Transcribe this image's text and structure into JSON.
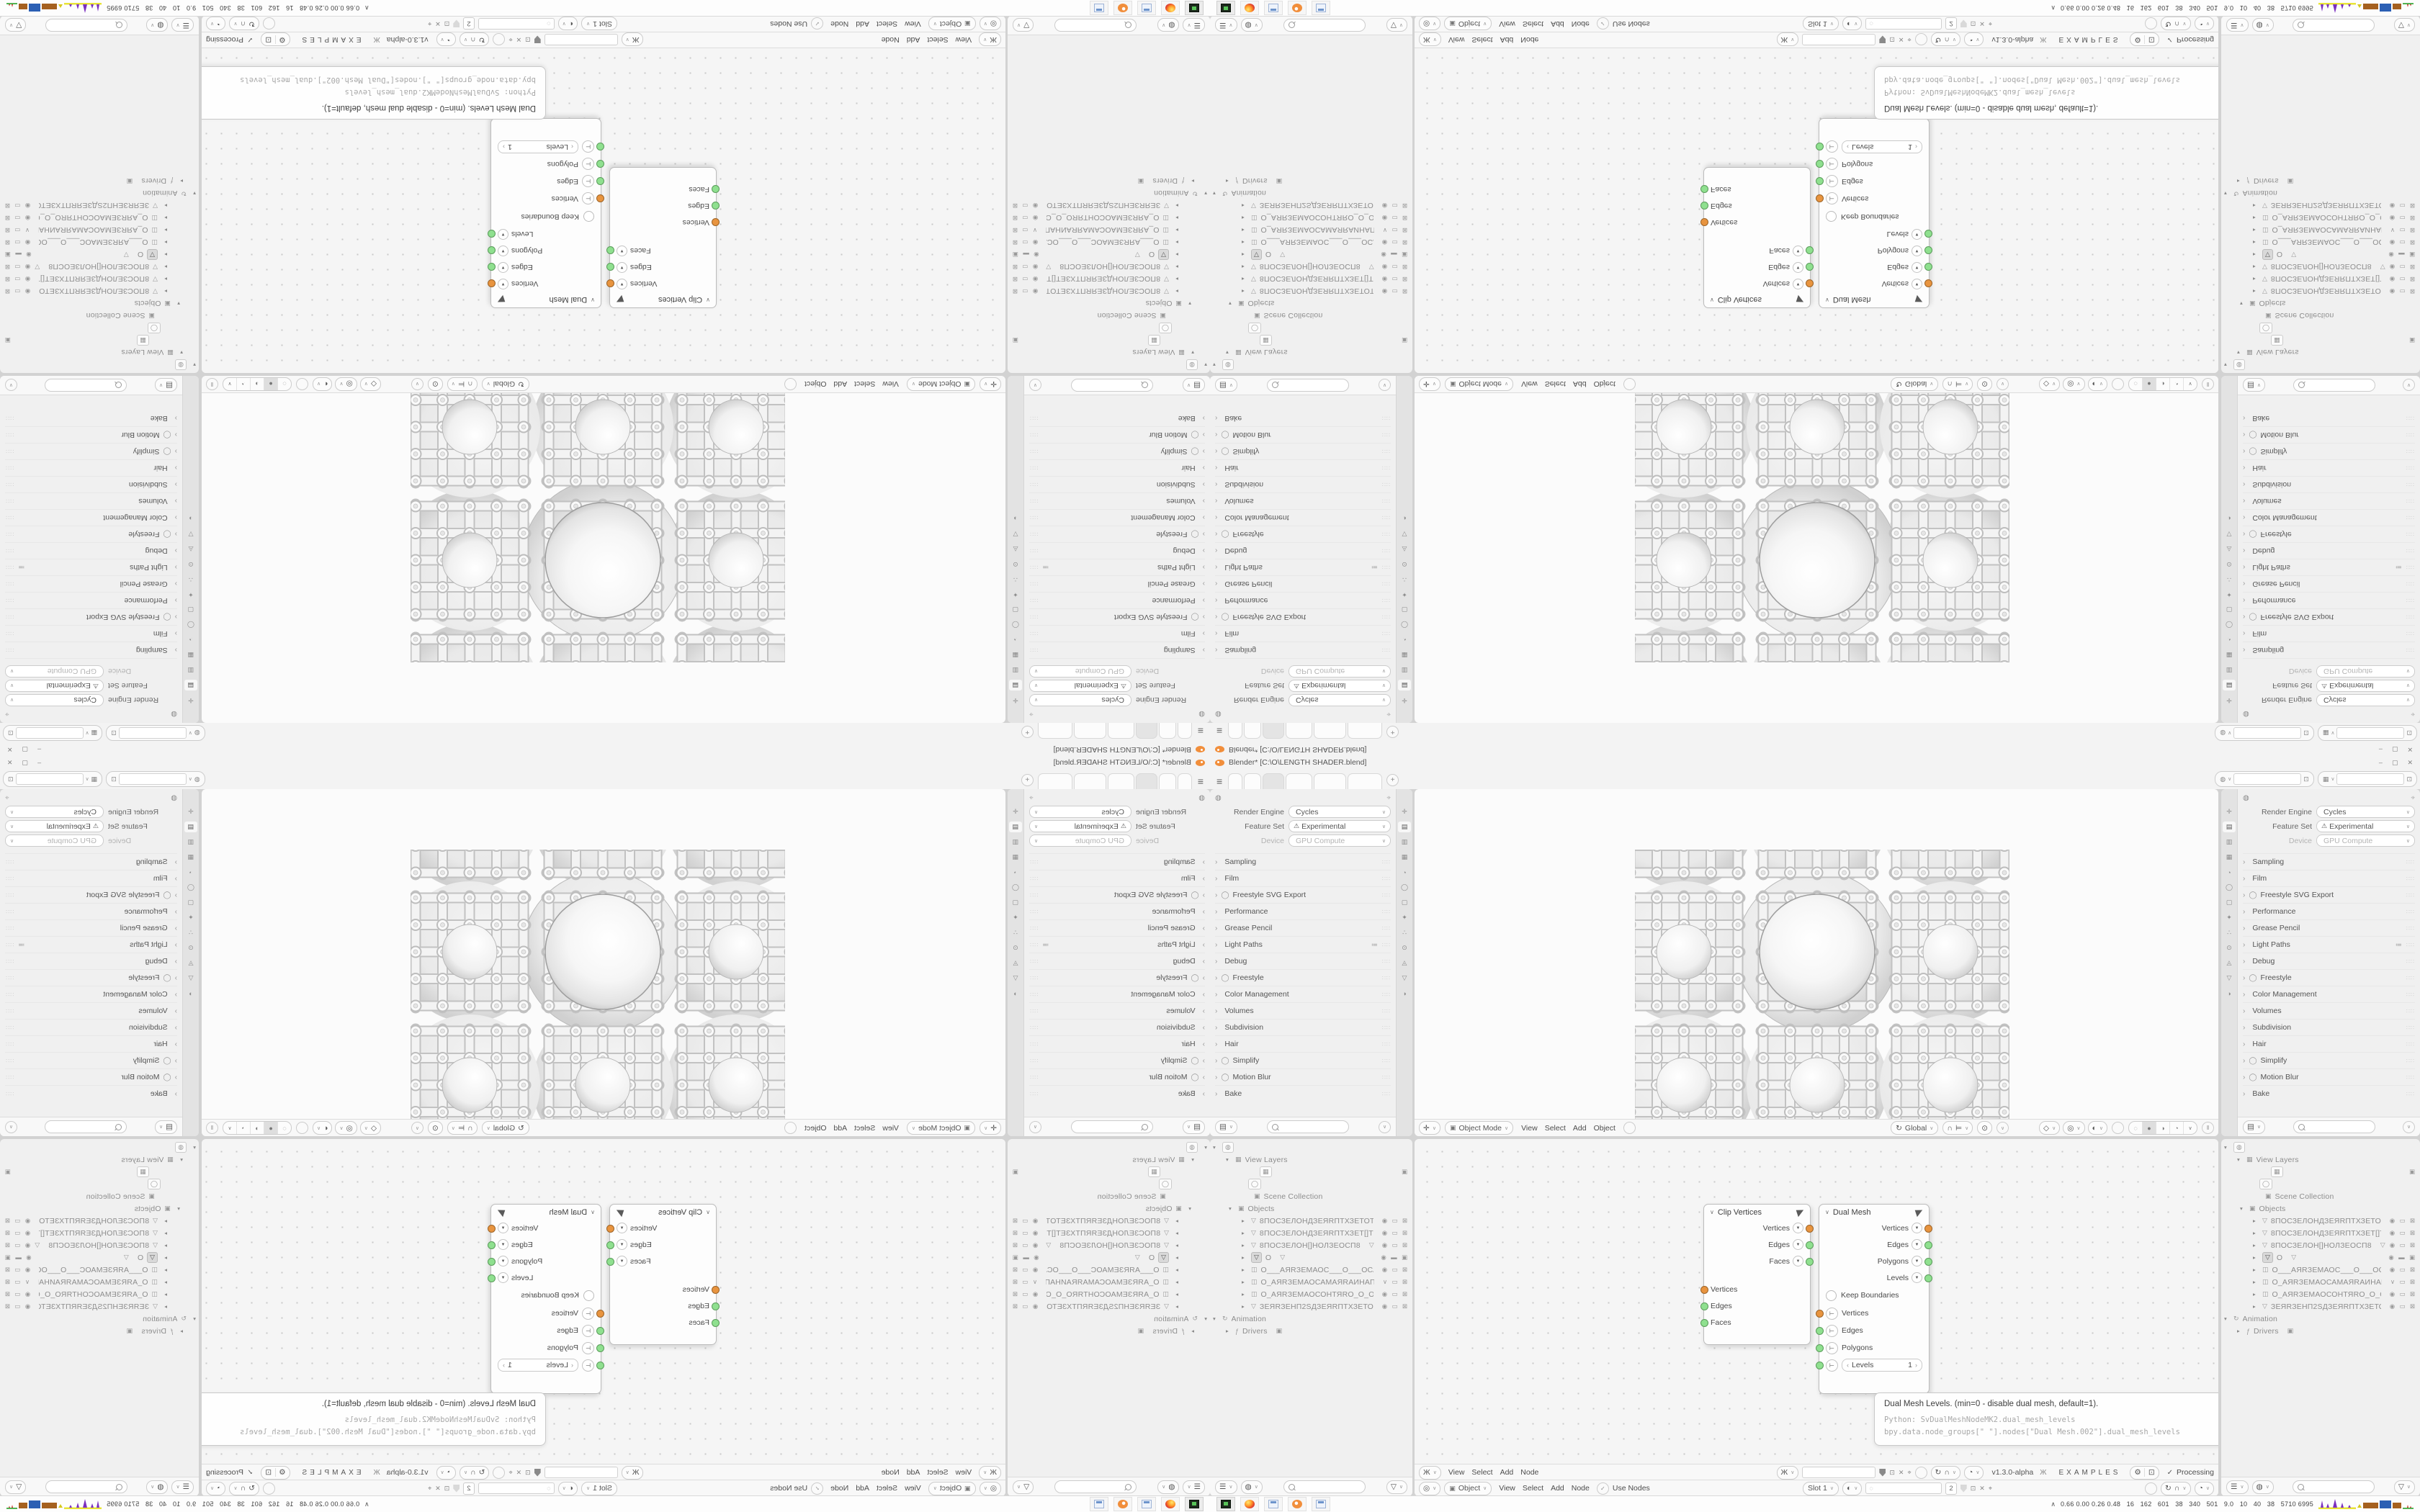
{
  "window": {
    "title": "Blender* [C:\\O\\LENGTH SHADER.blend]",
    "controls": {
      "minimize": "–",
      "maximize": "▢",
      "close": "✕"
    }
  },
  "topbar": {
    "tabs": [
      {
        "label": ""
      },
      {
        "label": ""
      },
      {
        "label": "",
        "cls": "on"
      },
      {
        "label": ""
      },
      {
        "label": ""
      },
      {
        "label": ""
      }
    ],
    "new_tab": "+",
    "scene": {
      "icon": "◍",
      "value": "",
      "copy": "⊡"
    },
    "view_layer": {
      "icon": "▦",
      "value": "",
      "copy": "⊡"
    }
  },
  "properties": {
    "editor_icon": "◍",
    "pin_icon": "⌖",
    "fields": [
      {
        "label": "Render Engine",
        "value": "Cycles"
      },
      {
        "label": "Feature Set",
        "value": "Experimental",
        "warn": "⚠"
      },
      {
        "label": "Device",
        "value": "GPU Compute",
        "cls": "dim"
      }
    ],
    "sections": [
      {
        "label": "Sampling"
      },
      {
        "label": "Film"
      },
      {
        "label": "Freestyle SVG Export",
        "cb": "◯"
      },
      {
        "label": "Performance"
      },
      {
        "label": "Grease Pencil"
      },
      {
        "label": "Light Paths",
        "preset": "≔"
      },
      {
        "label": "Debug"
      },
      {
        "label": "Freestyle",
        "cb": "◯"
      },
      {
        "label": "Color Management"
      },
      {
        "label": "Volumes"
      },
      {
        "label": "Subdivision"
      },
      {
        "label": "Hair"
      },
      {
        "label": "Simplify",
        "cb": "◯"
      },
      {
        "label": "Motion Blur",
        "cb": "◯"
      },
      {
        "label": "Bake"
      }
    ],
    "tab_icons": [
      {
        "name": "tool-icon",
        "g": "✛"
      },
      {
        "name": "render-properties-icon",
        "g": "▤",
        "cls": "on"
      },
      {
        "name": "output-properties-icon",
        "g": "▥"
      },
      {
        "name": "view-layer-properties-icon",
        "g": "▦"
      },
      {
        "name": "scene-properties-icon",
        "g": "◔"
      },
      {
        "name": "world-properties-icon",
        "g": "◯"
      },
      {
        "name": "object-properties-icon",
        "g": "▢"
      },
      {
        "name": "modifiers-icon",
        "g": "✦"
      },
      {
        "name": "particles-icon",
        "g": "∴"
      },
      {
        "name": "physics-icon",
        "g": "⊙"
      },
      {
        "name": "constraints-icon",
        "g": "◬"
      },
      {
        "name": "object-data-icon",
        "g": "▽"
      },
      {
        "name": "material-icon",
        "g": "◑"
      }
    ],
    "footer": {
      "display_icon": "▤"
    }
  },
  "viewport": {
    "header": {
      "editor_icon": "✛",
      "mode_icon": "▣",
      "mode": "Object Mode",
      "menus": [
        "View",
        "Select",
        "Add",
        "Object"
      ],
      "orientation": {
        "icon": "↻",
        "label": "Global"
      },
      "snap_icon": "∩",
      "snap_target_icon": "⊨",
      "proportional_icon": "⊙",
      "gizmo_icons": [
        {
          "name": "show-gizmo-icon",
          "g": "◇"
        },
        {
          "name": "overlays-icon",
          "g": "◎"
        },
        {
          "name": "xray-icon",
          "g": "◐"
        }
      ],
      "shading_icons": [
        {
          "name": "wireframe-shading-icon",
          "g": "◌"
        },
        {
          "name": "solid-shading-icon",
          "g": "●",
          "cls": "on"
        },
        {
          "name": "material-shading-icon",
          "g": "◑"
        },
        {
          "name": "rendered-shading-icon",
          "g": "◔"
        }
      ],
      "pause_icon": "‖"
    }
  },
  "outliner": {
    "rows": [
      {
        "pad": 4,
        "exp": "▾",
        "icon": "◍",
        "cls": "chip",
        "label": ""
      },
      {
        "pad": 22,
        "exp": "▾",
        "icon": "▦",
        "label": "View Layers"
      },
      {
        "pad": 56,
        "icon": "▦",
        "cls": "chip",
        "label": "",
        "right": "▣"
      },
      {
        "pad": 40,
        "icon": "◯",
        "cls": "chip",
        "label": ""
      },
      {
        "pad": 48,
        "icon": "▣",
        "label": "Scene Collection"
      },
      {
        "pad": 26,
        "exp": "▾",
        "icon": "▣",
        "label": "Objects"
      },
      {
        "pad": 44,
        "exp": "▸",
        "icon": "▽",
        "label": "8ПОСЗЕЛОНДЗЕЯRПТХЗЕТОТЗЕ0",
        "right": "◉ ▭ ⊠"
      },
      {
        "pad": 44,
        "exp": "▸",
        "icon": "▽",
        "label": "8ПОСЗЕЛОНДЗЕЯRПТХЗЕТ[]ТЗЕХ",
        "right": "◉ ▭ ⊠"
      },
      {
        "pad": 44,
        "exp": "▸",
        "icon": "▽",
        "label": "8ПОСЗЕЛОН[]НОЛЗЕОСП8",
        "tail": "▽",
        "right": "◉ ▭ ⊠"
      },
      {
        "pad": 44,
        "exp": "▸",
        "icon": "▽",
        "cls": "sel",
        "label": "O",
        "tail": "▽",
        "right": "◉ ▬ ▣"
      },
      {
        "pad": 44,
        "exp": "▸",
        "icon": "◫",
        "label": "O___АЯRЗЕМАОС___O___ОСАМЗ",
        "right": "◉ ▭ ⊠"
      },
      {
        "pad": 44,
        "exp": "▸",
        "icon": "◫",
        "label": "O_АЯRЗЕМАОСАМАЯRАИНАП_С",
        "right": "∨ ▭ ⊠"
      },
      {
        "pad": 44,
        "exp": "▸",
        "icon": "◫",
        "label": "O_АЯRЗЕМАОСОНТЯRО_O_ОЯRТН",
        "right": "◉ ▭ ⊠"
      },
      {
        "pad": 44,
        "exp": "▸",
        "icon": "▽",
        "label": "ЗЕЯRЗЕНП2SДЗЕЯRПТХЗЕТОТЗЕ",
        "right": "◉ ▭ ⊠"
      },
      {
        "pad": 4,
        "exp": "▾",
        "icon": "↻",
        "label": "Animation"
      },
      {
        "pad": 22,
        "exp": "▸",
        "icon": "ƒ",
        "label": "Drivers",
        "tail": "▣"
      }
    ],
    "filter": {
      "display_icon": "☰",
      "filter_icon": "◍",
      "funnel_icon": "▽"
    }
  },
  "node_editor": {
    "header": {
      "editor_icon": "Ж",
      "menus": [
        "View",
        "Select",
        "Add",
        "Node"
      ],
      "tree_name": "",
      "version": "v1.3.0-alpha",
      "dna_icon": "Ж",
      "examples": "EXAMPLES",
      "check": "✓",
      "processing": "Processing"
    },
    "shader_header": {
      "editor_icon": "◎",
      "context_icon": "▣",
      "context": "Object",
      "menus": [
        "View",
        "Select",
        "Add",
        "Node"
      ],
      "use_nodes_check": "✓",
      "use_nodes": "Use Nodes",
      "slot": "Slot 1",
      "world_icon": "◐",
      "material_icon": "◌",
      "users_count": "2"
    },
    "nodes": {
      "clip": {
        "title": "Clip Vertices",
        "outputs": [
          "Vertices",
          "Edges",
          "Faces"
        ],
        "inputs": [
          "Vertices",
          "Edges",
          "Faces"
        ]
      },
      "dual": {
        "title": "Dual Mesh",
        "outputs": [
          "Vertices",
          "Edges",
          "Polygons",
          "Levels"
        ],
        "checkbox": "Keep Boundaries",
        "inputs": [
          "Vertices",
          "Edges",
          "Polygons"
        ],
        "levels": {
          "label": "Levels",
          "value": "1"
        }
      }
    },
    "tooltip": {
      "title": "Dual Mesh Levels. (min=0 - disable dual mesh, default=1).",
      "python": "Python: SvDualMeshNodeMK2.dual_mesh_levels",
      "path": "bpy.data.node_groups[\" \"].nodes[\"Dual Mesh.002\"].dual_mesh_levels"
    }
  },
  "taskbar": {
    "apps": [
      {
        "name": "file-manager-icon",
        "cls": "fm"
      },
      {
        "name": "firefox-icon",
        "cls": "fx"
      },
      {
        "name": "calculator-icon",
        "cls": "calc"
      },
      {
        "name": "blender-icon",
        "cls": "bl"
      },
      {
        "name": "calculator-2-icon",
        "cls": "calc"
      }
    ],
    "tray_expand": "∧",
    "tray_text": "0.66 0.00 0.26 0.48   16   162   601   38   340   501   9.0   10   40   38   5710 6995"
  },
  "colors": {
    "accent_orange": "#f18e3b",
    "socket_vertices": "#e8943f",
    "socket_data": "#8fe08f",
    "tray_purple": "#7b2fbe",
    "tray_yellow": "#e8e337",
    "tray_brown": "#a5601f",
    "tray_blue": "#2b5fb4",
    "tray_green": "#3faa3f",
    "tray_red": "#cc2a2a"
  }
}
